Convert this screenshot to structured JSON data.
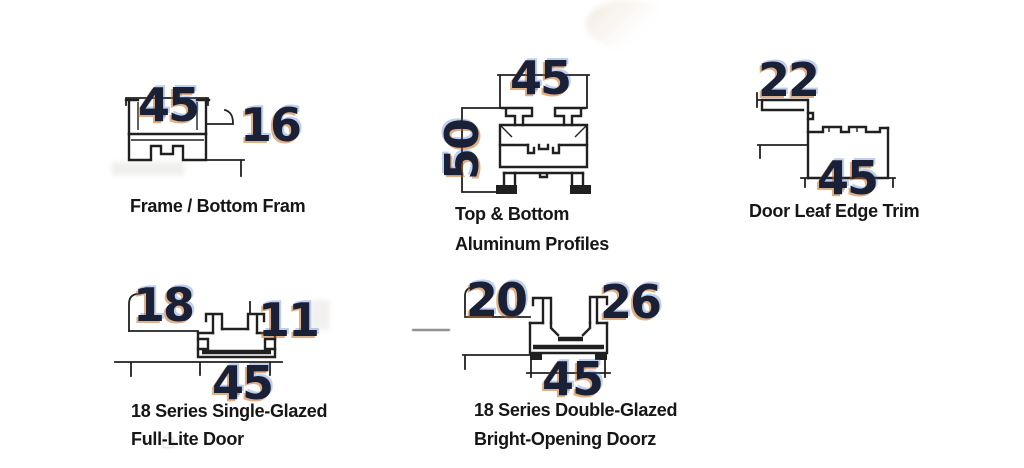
{
  "sheet": {
    "title": "Aluminum door profile cross-sections"
  },
  "colors": {
    "background": "#ffffff",
    "line": "#202020",
    "number": "#1a2036",
    "number_fringe_warm": "#bf6210",
    "number_fringe_cool": "#2c60cd",
    "label": "#161616"
  },
  "icons": {
    "house_watermark": "⌂"
  },
  "diagrams": [
    {
      "name": "frame-bottom-frame",
      "label_lines": [
        "Frame / Bottom Fram"
      ],
      "dims": {
        "top_width": "45",
        "right_height": "16"
      }
    },
    {
      "name": "top-bottom-aluminum-profiles",
      "label_lines": [
        "Top & Bottom",
        "Aluminum Profiles"
      ],
      "dims": {
        "top_width": "45",
        "left_height": "50"
      }
    },
    {
      "name": "door-leaf-edge-trim",
      "label_lines": [
        "Door Leaf Edge Trim"
      ],
      "dims": {
        "top_width": "22",
        "bottom_width": "45"
      }
    },
    {
      "name": "series18-single-glazed-full-lite-door",
      "label_lines": [
        "18 Series Single-Glazed",
        "Full-Lite Door"
      ],
      "dims": {
        "left_height": "18",
        "channel_width": "11",
        "bottom_width": "45"
      }
    },
    {
      "name": "series18-double-glazed-bright-opening-door",
      "label_lines": [
        "18 Series Double-Glazed",
        "Bright-Opening Doorz"
      ],
      "dims": {
        "left_width": "20",
        "right_width": "26",
        "bottom_width": "45"
      }
    }
  ]
}
